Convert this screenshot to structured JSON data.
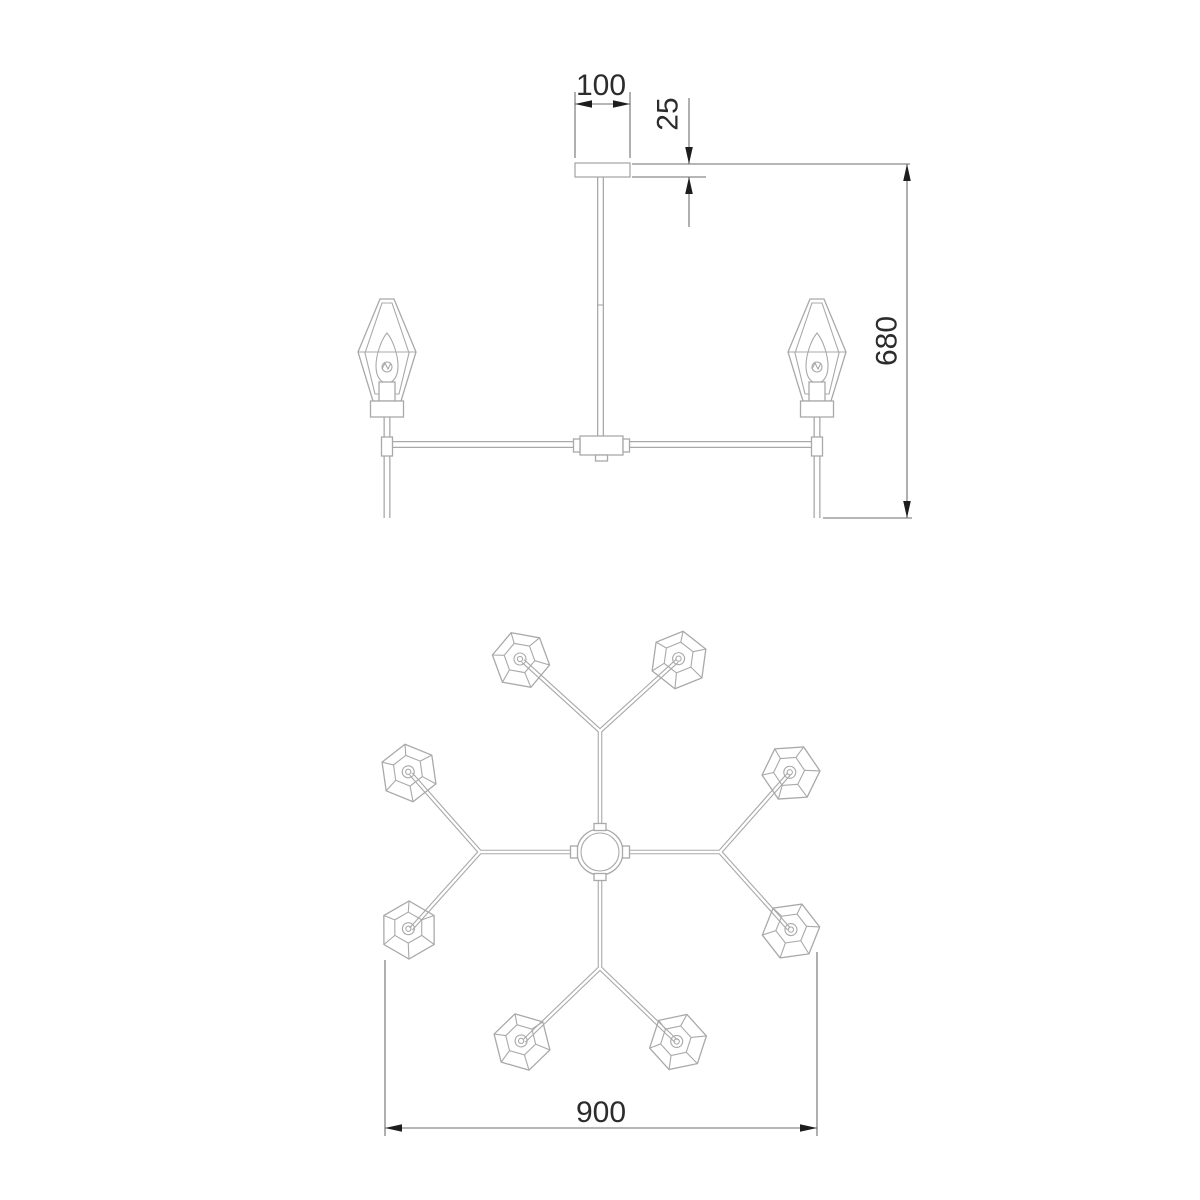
{
  "drawing": {
    "kind": "chandelier-dimension-drawing",
    "views": {
      "side_view_lamp_count": 2,
      "plan_view_shade_count": 8
    },
    "dimensions": {
      "mount_width": "100",
      "mount_thickness": "25",
      "overall_height": "680",
      "overall_diameter": "900"
    },
    "colors": {
      "fixture_line": "#a9a9a9",
      "dimension_line": "#6e6e6e",
      "dimension_text": "#2c2c2c",
      "arrowhead": "#1d1d1d",
      "background": "#ffffff"
    }
  }
}
